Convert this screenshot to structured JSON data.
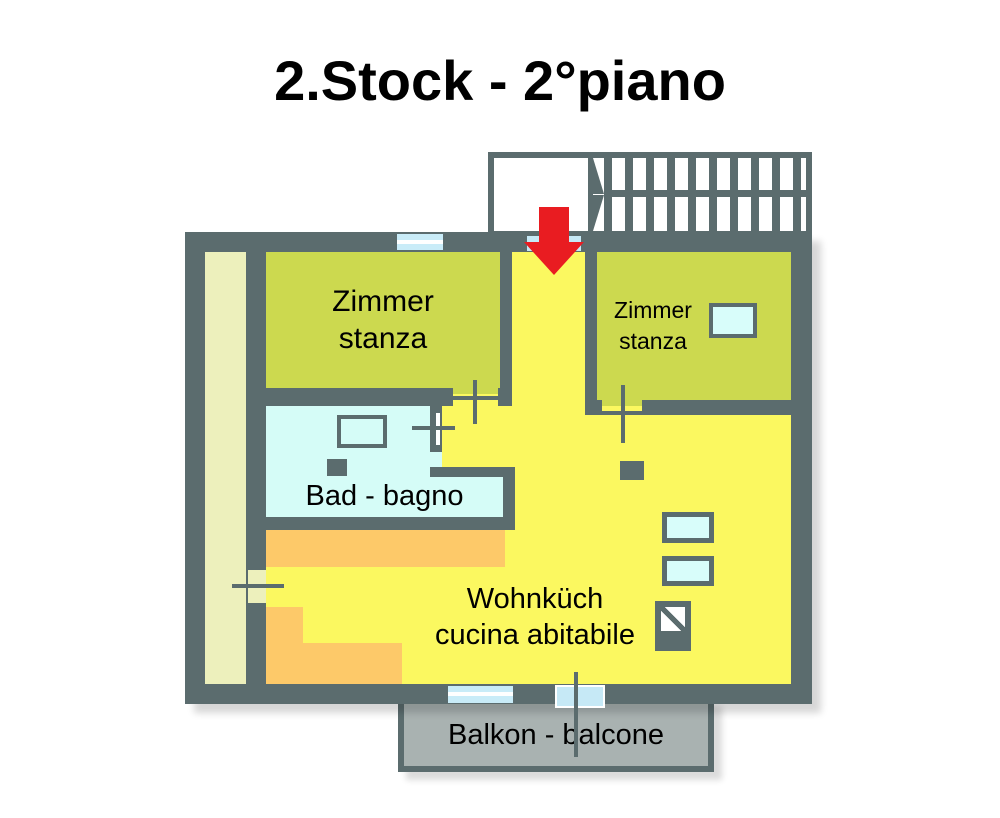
{
  "title": "2.Stock - 2°piano",
  "rooms": {
    "zimmer_left": {
      "line1": "Zimmer",
      "line2": "stanza"
    },
    "zimmer_right": {
      "line1": "Zimmer",
      "line2": "stanza"
    },
    "bad": {
      "label": "Bad - bagno"
    },
    "wohnkueche": {
      "line1": "Wohnküch",
      "line2": "cucina abitabile"
    },
    "balkon": {
      "label": "Balkon - balcone"
    }
  },
  "icons": {
    "entrance_arrow": "red-down-arrow",
    "staircase": "exterior-stair-treads",
    "dimension_cross": "plus-marker"
  },
  "palette": {
    "wall": "#5b6c6e",
    "floor_yellow": "#fbf860",
    "room_olive": "#ccd94f",
    "pale_strip": "#edf0bc",
    "bath_cyan": "#d5fcf7",
    "fixture_cyan": "#d8fdfa",
    "window_cyan": "#c9ecf8",
    "door_cyan": "#c6e9f6",
    "orange": "#fdc969",
    "balcony_gray": "#a9b2b1",
    "arrow_red": "#e91c21"
  }
}
